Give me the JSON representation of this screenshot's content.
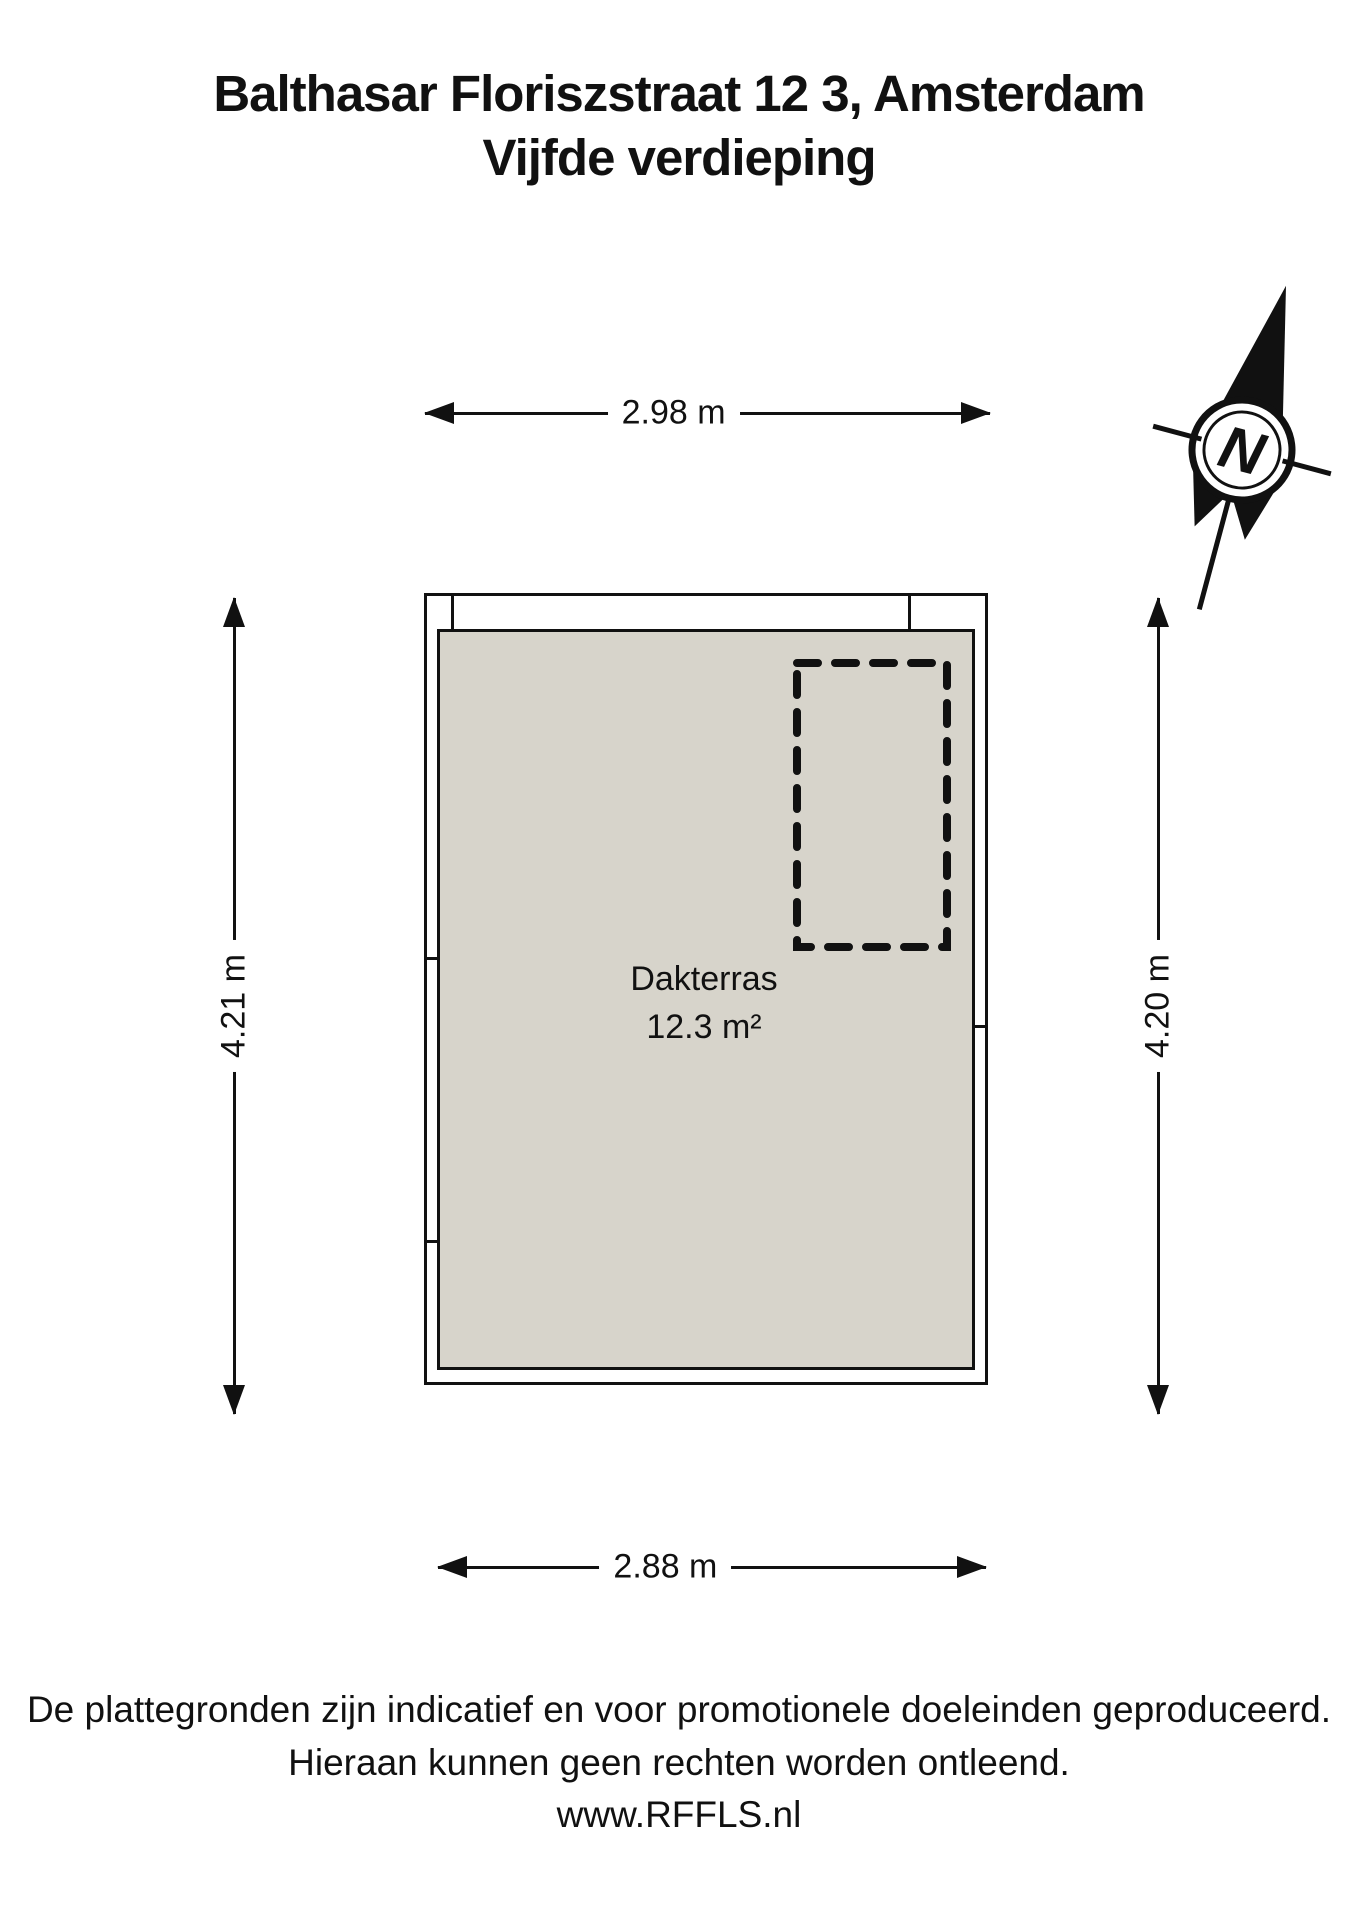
{
  "title": {
    "line1": "Balthasar Floriszstraat 12 3, Amsterdam",
    "line2": "Vijfde verdieping"
  },
  "compass": {
    "north_label": "N"
  },
  "dimensions": {
    "top": "2.98 m",
    "left": "4.21 m",
    "right": "4.20 m",
    "bottom": "2.88 m"
  },
  "room": {
    "name": "Dakterras",
    "area": "12.3 m²"
  },
  "footer": {
    "line1": "De plattegronden zijn indicatief en voor promotionele doeleinden geproduceerd.",
    "line2": "Hieraan kunnen geen rechten worden ontleend.",
    "line3": "www.RFFLS.nl"
  },
  "colors": {
    "floor_fill": "#d7d4cb",
    "wall_fill": "#ffffff",
    "line": "#111111"
  }
}
